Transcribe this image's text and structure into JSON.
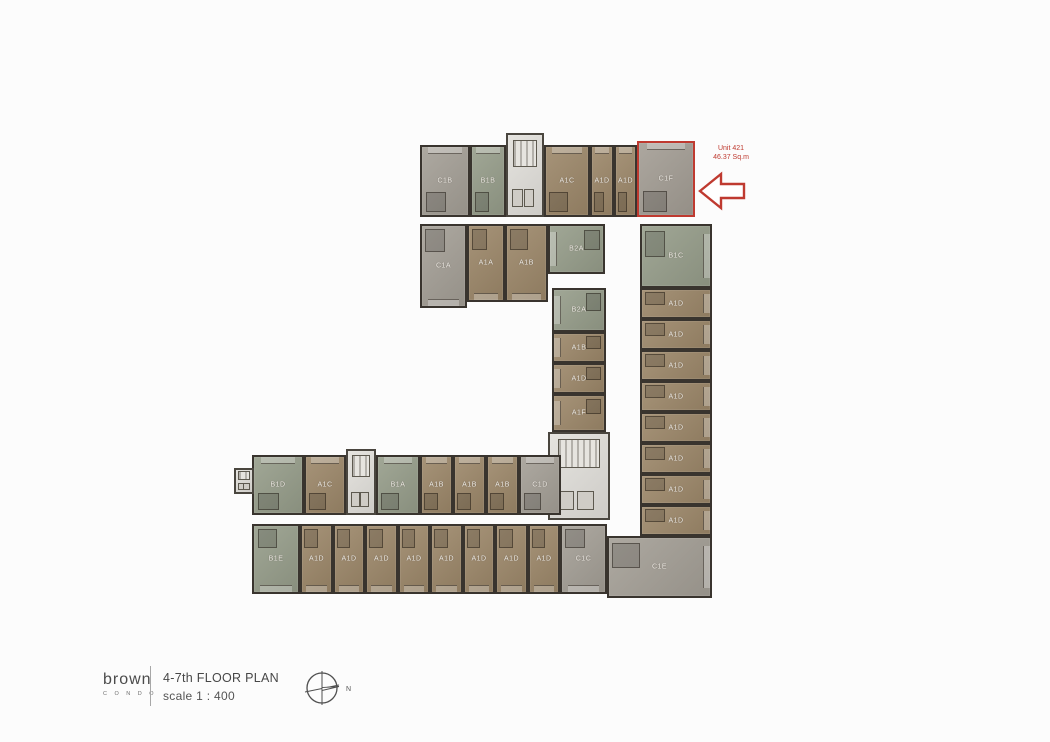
{
  "annotation": {
    "line1": "Unit 421",
    "line2": "46.37 Sq.m",
    "highlighted_unit": "C1F"
  },
  "footer": {
    "brand": "brown",
    "brand_sub": "C O N D O",
    "title": "4-7th FLOOR PLAN",
    "scale": "scale 1 : 400",
    "compass_label": "N"
  },
  "colors": {
    "unit_type_a_brown": "#9c8769",
    "unit_type_b_green": "#969d8a",
    "unit_type_c_grey": "#a49f96",
    "core_light_grey": "#e2e0db",
    "wall_dark": "#39342e",
    "highlight_red": "#bf3a30",
    "background": "#fcfcfc"
  },
  "plan": {
    "units": [
      {
        "label": "C1B",
        "type": "c",
        "orient": "up",
        "x": 420,
        "y": 145,
        "w": 50,
        "h": 72
      },
      {
        "label": "B1B",
        "type": "b",
        "orient": "up",
        "x": 470,
        "y": 145,
        "w": 36,
        "h": 72
      },
      {
        "label": "",
        "type": "core",
        "orient": "",
        "x": 506,
        "y": 133,
        "w": 38,
        "h": 84
      },
      {
        "label": "A1C",
        "type": "a",
        "orient": "up",
        "x": 544,
        "y": 145,
        "w": 46,
        "h": 72
      },
      {
        "label": "A1D",
        "type": "a",
        "orient": "up",
        "x": 590,
        "y": 145,
        "w": 24,
        "h": 72
      },
      {
        "label": "A1D",
        "type": "a",
        "orient": "up",
        "x": 614,
        "y": 145,
        "w": 23,
        "h": 72
      },
      {
        "label": "C1F",
        "type": "red",
        "orient": "up",
        "x": 637,
        "y": 141,
        "w": 58,
        "h": 76
      },
      {
        "label": "C1A",
        "type": "c",
        "orient": "down",
        "x": 420,
        "y": 224,
        "w": 47,
        "h": 84
      },
      {
        "label": "A1A",
        "type": "a",
        "orient": "down",
        "x": 467,
        "y": 224,
        "w": 38,
        "h": 78
      },
      {
        "label": "A1B",
        "type": "a",
        "orient": "down",
        "x": 505,
        "y": 224,
        "w": 43,
        "h": 78
      },
      {
        "label": "B2A",
        "type": "b",
        "orient": "left",
        "x": 548,
        "y": 224,
        "w": 57,
        "h": 50
      },
      {
        "label": "B1C",
        "type": "b",
        "orient": "right",
        "x": 640,
        "y": 224,
        "w": 72,
        "h": 64
      },
      {
        "label": "B2A",
        "type": "b",
        "orient": "left",
        "x": 552,
        "y": 288,
        "w": 54,
        "h": 44
      },
      {
        "label": "A1B",
        "type": "a",
        "orient": "left",
        "x": 552,
        "y": 332,
        "w": 54,
        "h": 31
      },
      {
        "label": "A1D",
        "type": "a",
        "orient": "left",
        "x": 552,
        "y": 363,
        "w": 54,
        "h": 31
      },
      {
        "label": "A1F",
        "type": "a",
        "orient": "left",
        "x": 552,
        "y": 394,
        "w": 54,
        "h": 38
      },
      {
        "label": "",
        "type": "core",
        "orient": "",
        "x": 548,
        "y": 432,
        "w": 62,
        "h": 88
      },
      {
        "label": "A1D",
        "type": "a",
        "orient": "right",
        "x": 640,
        "y": 288,
        "w": 72,
        "h": 31
      },
      {
        "label": "A1D",
        "type": "a",
        "orient": "right",
        "x": 640,
        "y": 319,
        "w": 72,
        "h": 31
      },
      {
        "label": "A1D",
        "type": "a",
        "orient": "right",
        "x": 640,
        "y": 350,
        "w": 72,
        "h": 31
      },
      {
        "label": "A1D",
        "type": "a",
        "orient": "right",
        "x": 640,
        "y": 381,
        "w": 72,
        "h": 31
      },
      {
        "label": "A1D",
        "type": "a",
        "orient": "right",
        "x": 640,
        "y": 412,
        "w": 72,
        "h": 31
      },
      {
        "label": "A1D",
        "type": "a",
        "orient": "right",
        "x": 640,
        "y": 443,
        "w": 72,
        "h": 31
      },
      {
        "label": "A1D",
        "type": "a",
        "orient": "right",
        "x": 640,
        "y": 474,
        "w": 72,
        "h": 31
      },
      {
        "label": "A1D",
        "type": "a",
        "orient": "right",
        "x": 640,
        "y": 505,
        "w": 72,
        "h": 31
      },
      {
        "label": "C1E",
        "type": "c",
        "orient": "right",
        "x": 607,
        "y": 536,
        "w": 105,
        "h": 62
      },
      {
        "label": "B1D",
        "type": "b",
        "orient": "up",
        "x": 252,
        "y": 455,
        "w": 52,
        "h": 60
      },
      {
        "label": "A1C",
        "type": "a",
        "orient": "up",
        "x": 304,
        "y": 455,
        "w": 42,
        "h": 60
      },
      {
        "label": "",
        "type": "core",
        "orient": "",
        "x": 346,
        "y": 449,
        "w": 30,
        "h": 66
      },
      {
        "label": "B1A",
        "type": "b",
        "orient": "up",
        "x": 376,
        "y": 455,
        "w": 44,
        "h": 60
      },
      {
        "label": "A1B",
        "type": "a",
        "orient": "up",
        "x": 420,
        "y": 455,
        "w": 33,
        "h": 60
      },
      {
        "label": "A1B",
        "type": "a",
        "orient": "up",
        "x": 453,
        "y": 455,
        "w": 33,
        "h": 60
      },
      {
        "label": "A1B",
        "type": "a",
        "orient": "up",
        "x": 486,
        "y": 455,
        "w": 33,
        "h": 60
      },
      {
        "label": "C1D",
        "type": "c",
        "orient": "up",
        "x": 519,
        "y": 455,
        "w": 42,
        "h": 60
      },
      {
        "label": "B1E",
        "type": "b",
        "orient": "down",
        "x": 252,
        "y": 524,
        "w": 48,
        "h": 70
      },
      {
        "label": "A1D",
        "type": "a",
        "orient": "down",
        "x": 300,
        "y": 524,
        "w": 33,
        "h": 70
      },
      {
        "label": "A1D",
        "type": "a",
        "orient": "down",
        "x": 333,
        "y": 524,
        "w": 32,
        "h": 70
      },
      {
        "label": "A1D",
        "type": "a",
        "orient": "down",
        "x": 365,
        "y": 524,
        "w": 33,
        "h": 70
      },
      {
        "label": "A1D",
        "type": "a",
        "orient": "down",
        "x": 398,
        "y": 524,
        "w": 32,
        "h": 70
      },
      {
        "label": "A1D",
        "type": "a",
        "orient": "down",
        "x": 430,
        "y": 524,
        "w": 33,
        "h": 70
      },
      {
        "label": "A1D",
        "type": "a",
        "orient": "down",
        "x": 463,
        "y": 524,
        "w": 32,
        "h": 70
      },
      {
        "label": "A1D",
        "type": "a",
        "orient": "down",
        "x": 495,
        "y": 524,
        "w": 33,
        "h": 70
      },
      {
        "label": "A1D",
        "type": "a",
        "orient": "down",
        "x": 528,
        "y": 524,
        "w": 32,
        "h": 70
      },
      {
        "label": "C1C",
        "type": "c",
        "orient": "down",
        "x": 560,
        "y": 524,
        "w": 47,
        "h": 70
      },
      {
        "label": "",
        "type": "core",
        "orient": "",
        "x": 234,
        "y": 468,
        "w": 20,
        "h": 26
      }
    ]
  }
}
